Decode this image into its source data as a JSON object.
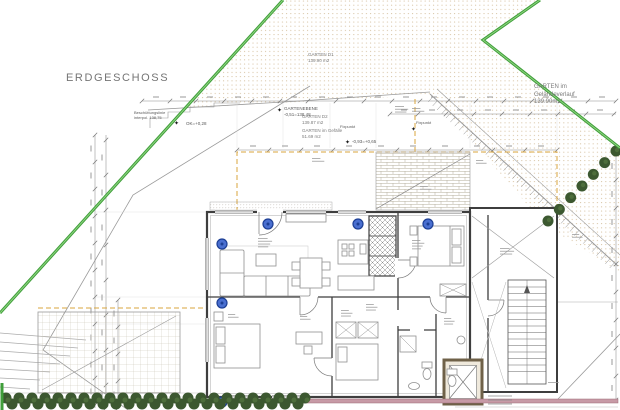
{
  "title": "ERDGESCHOSS",
  "icons": {
    "survey_star": "✦"
  },
  "colors": {
    "boundary_green": "#3f9e3a",
    "boundary_green_light": "#8ed47f",
    "hedge_dark": "#3c5830",
    "hedge_light": "#5a7d45",
    "marker_blue_fill": "#4a6fd0",
    "marker_blue_ring": "#1d3f94",
    "dashed_orange": "#d9a43c",
    "retaining_pink": "#c79aa6",
    "dot_tan": "#cdb48c"
  },
  "garden_labels": {
    "d1": {
      "name": "GARTEN D1",
      "area": "139.90 m2"
    },
    "verlauf": {
      "line1": "GARTEN im",
      "line2": "Geländeverlauf",
      "area": "139.90m2"
    },
    "d2": {
      "name": "GARTEN D2",
      "area": "139.87 m2"
    },
    "gefaelle": {
      "name": "GARTEN im Gefälle",
      "area": "51.69 m2"
    }
  },
  "annotations": {
    "beschuettung_1": "Beschüttungslinie",
    "beschuettung_2": "interpol. 138,75",
    "ok_note": "OK=+0,28",
    "gartenebene_1": "GARTENEBENE",
    "gartenebene_2": "-0,51=138,48",
    "fixpunkt": "Fixpunkt",
    "hoehe_note": "-0,93=+0,65"
  }
}
